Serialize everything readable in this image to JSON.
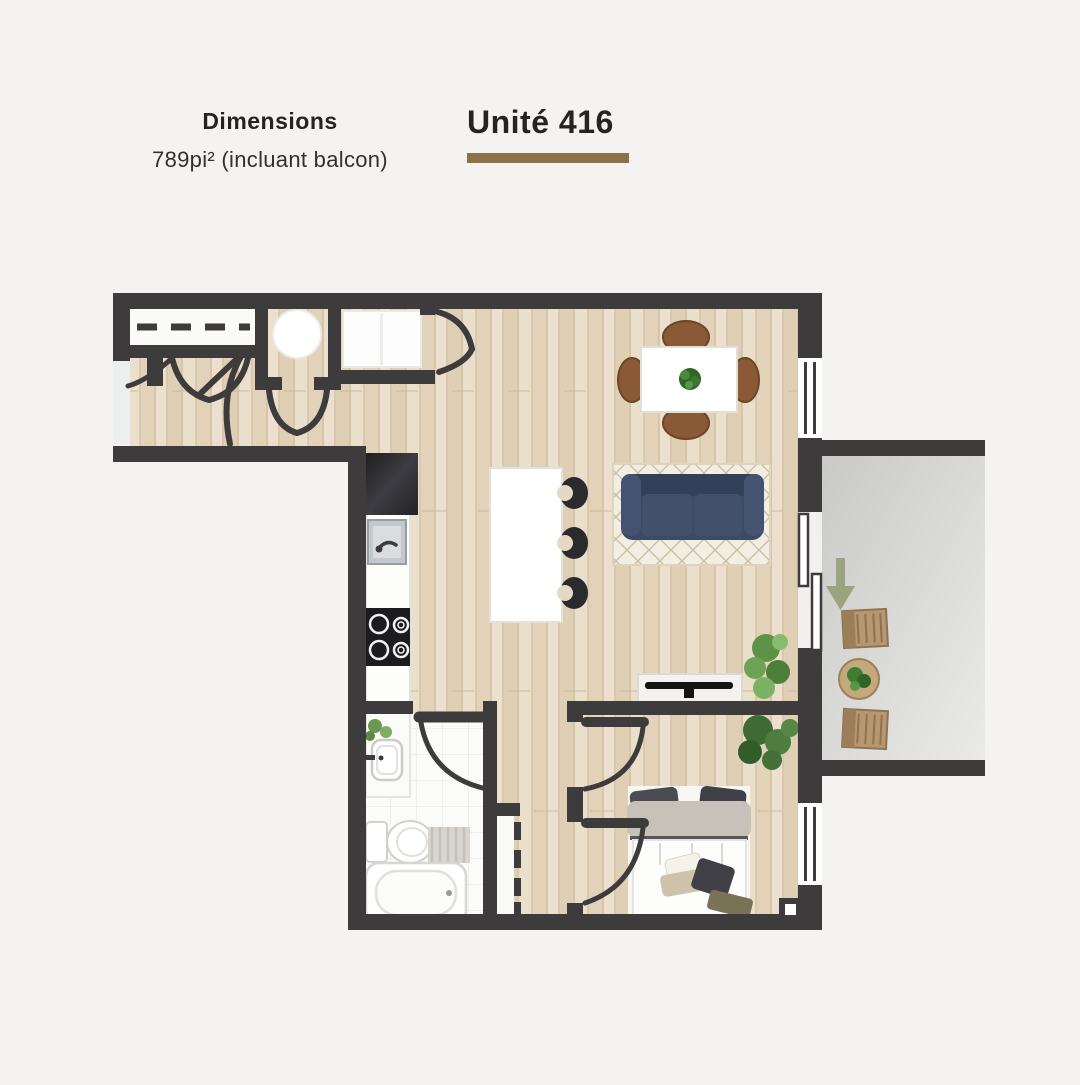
{
  "header": {
    "dimensions_label": "Dimensions",
    "dimensions_value": "789pi² (incluant balcon)",
    "unit_title": "Unité 416"
  },
  "palette": {
    "page_background": "#f4f3f1",
    "wall": "#3e3b3c",
    "wood_floor": "#e5d8c2",
    "tile_floor": "#fbfbfa",
    "balcony_floor": "#d6d6d4",
    "accent_bar": "#8c7347",
    "sofa": "#3c4a63",
    "rug": "#f2eee3",
    "dining_chair": "#8a5a36",
    "plant": "#4e7d3a",
    "entry_arrow": "#9aa47e"
  },
  "plan": {
    "furniture": [
      "dining-table",
      "dining-chairs",
      "sofa",
      "area-rug",
      "kitchen-island",
      "bar-stools",
      "refrigerator",
      "kitchen-sink",
      "cooktop",
      "tv-console",
      "bed",
      "bathtub",
      "toilet",
      "vanity-sink",
      "washer-dryer",
      "water-heater",
      "balcony-chairs",
      "balcony-table",
      "plants"
    ],
    "openings": [
      "entry-door",
      "closet-doors",
      "bathroom-door",
      "bedroom-doors",
      "sliding-balcony-door",
      "windows"
    ]
  }
}
